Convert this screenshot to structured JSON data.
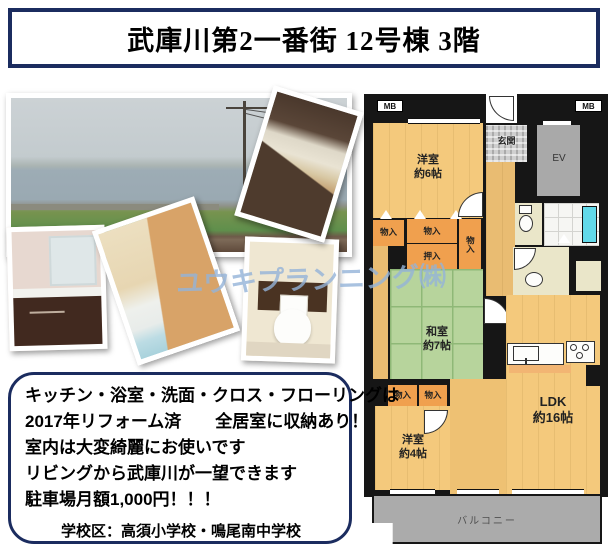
{
  "title": {
    "text": "武庫川第2一番街 12号棟 3階"
  },
  "watermark": {
    "text": "ユウキプランニング㈱",
    "color": "#94b3d8"
  },
  "photos": {
    "names": [
      "river-view",
      "kitchen",
      "vanity",
      "bathroom",
      "toilet"
    ]
  },
  "floorplan": {
    "labels": {
      "mb": "MB",
      "genkan": "玄関",
      "ev": "EV",
      "yoshitsu6": "洋室\n約6帖",
      "washitsu7": "和室\n約7帖",
      "yoshitsu4": "洋室\n約4帖",
      "ldk": "LDK\n約16帖",
      "monoire": "物入",
      "oshiire": "押入",
      "balcony": "バルコニー"
    },
    "colors": {
      "room_orange": "#f4c97c",
      "storage_orange": "#f0a04e",
      "tatami_green": "#b7d49c",
      "balcony_gray": "#ababab",
      "tub_cyan": "#62d9e9",
      "wall_black": "#161616"
    }
  },
  "description": {
    "lines": [
      "キッチン・浴室・洗面・クロス・フローリングは",
      "2017年リフォーム済　　全居室に収納あり！",
      "室内は大変綺麗にお使いです",
      "リビングから武庫川が一望できます",
      "駐車場月額1,000円！！！"
    ],
    "school": "学校区：高須小学校・鳴尾南中学校"
  },
  "accent_color": "#1b2c5f"
}
